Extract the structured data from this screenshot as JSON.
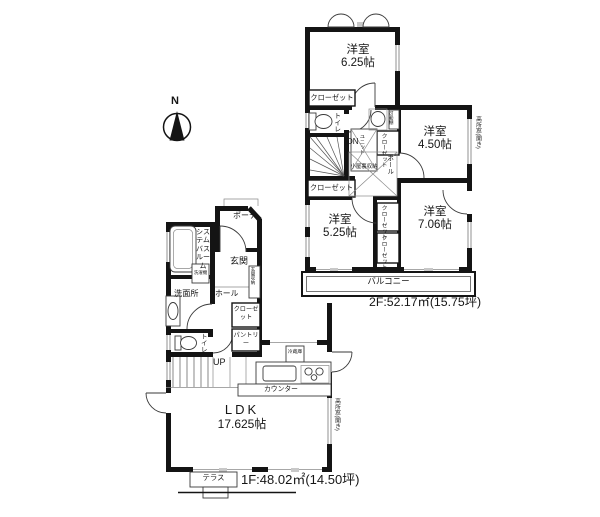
{
  "colors": {
    "wall": "#141414",
    "win": "#c8c8c8",
    "line": "#3a3a3a"
  },
  "compass": {
    "north": "N"
  },
  "f2": {
    "rooms": [
      {
        "name": "洋室",
        "size": "6.25帖"
      },
      {
        "name": "洋室",
        "size": "4.50帖"
      },
      {
        "name": "洋室",
        "size": "5.25帖"
      },
      {
        "name": "洋室",
        "size": "7.06帖"
      }
    ],
    "closet_a": "クローゼット",
    "closet_b": "クローゼット",
    "closet_hall": "クローゼット",
    "closet_c": "クローゼット",
    "closet_d": "クローゼット",
    "toilet": "トイレ",
    "dn": "DN",
    "attic": "小屋裏収納",
    "attic_unit": "ユニット",
    "hall": "ホール",
    "shelf": "可動棚",
    "balcony": "バルコニー",
    "high_window": "高所窓(開き)",
    "area": "2F:52.17㎡(15.75坪)"
  },
  "f1": {
    "porch": "ポーチ",
    "entrance": "玄関",
    "bathroom": "システムバスルーム",
    "washroom": "洗面所",
    "washer": "洗濯機",
    "hall": "ホール",
    "entrance_storage": "玄関収納",
    "closet": "クローゼット",
    "pantry": "パントリー",
    "toilet": "トイレ",
    "up": "UP",
    "fridge": "冷蔵庫",
    "counter": "カウンター",
    "ldk": {
      "name": "LDK",
      "size": "17.625帖"
    },
    "terrace": "テラス",
    "high_window": "高所窓(開き)",
    "area": "1F:48.02㎡(14.50坪)"
  }
}
